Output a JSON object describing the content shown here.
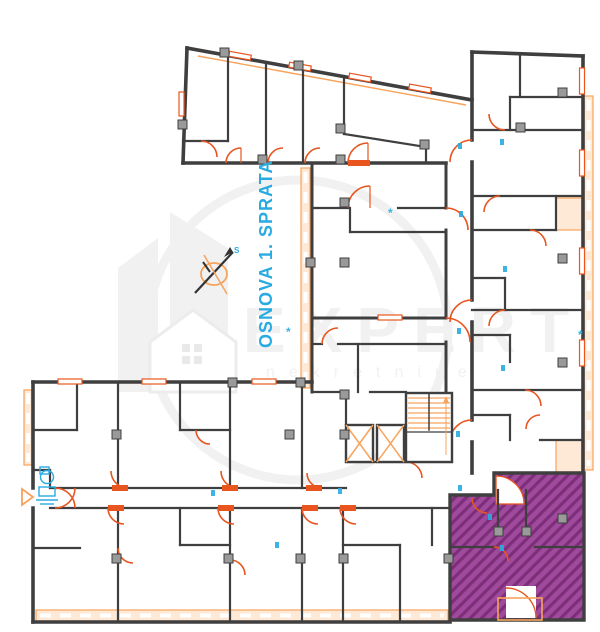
{
  "page": {
    "background": "#FFFFFF"
  },
  "title": {
    "text": "OSNOVA 1. SPRATA",
    "color": "#29ABE2",
    "orientation": "vertical"
  },
  "watermark": {
    "brand": "EXPERT",
    "subtitle": "nekretnine",
    "color": "#F1F1F1"
  },
  "north_arrow": {
    "label": "S"
  },
  "highlighted_unit": {
    "fill": "#A04A9E",
    "hatch": "#7C2F78",
    "style": "diagonal-hatch"
  },
  "colors": {
    "background": "#FFFFFF",
    "wall": "#3F3F3F",
    "door_accent": "#E8551F",
    "light_accent": "#F7A35C",
    "balcony_fill": "#FDE9D6",
    "title_blue": "#29ABE2",
    "unit_purple": "#A04A9E",
    "unit_hatch": "#7C2F78",
    "watermark_gray": "#F1F1F1",
    "column_gray": "#9A9A9A"
  }
}
